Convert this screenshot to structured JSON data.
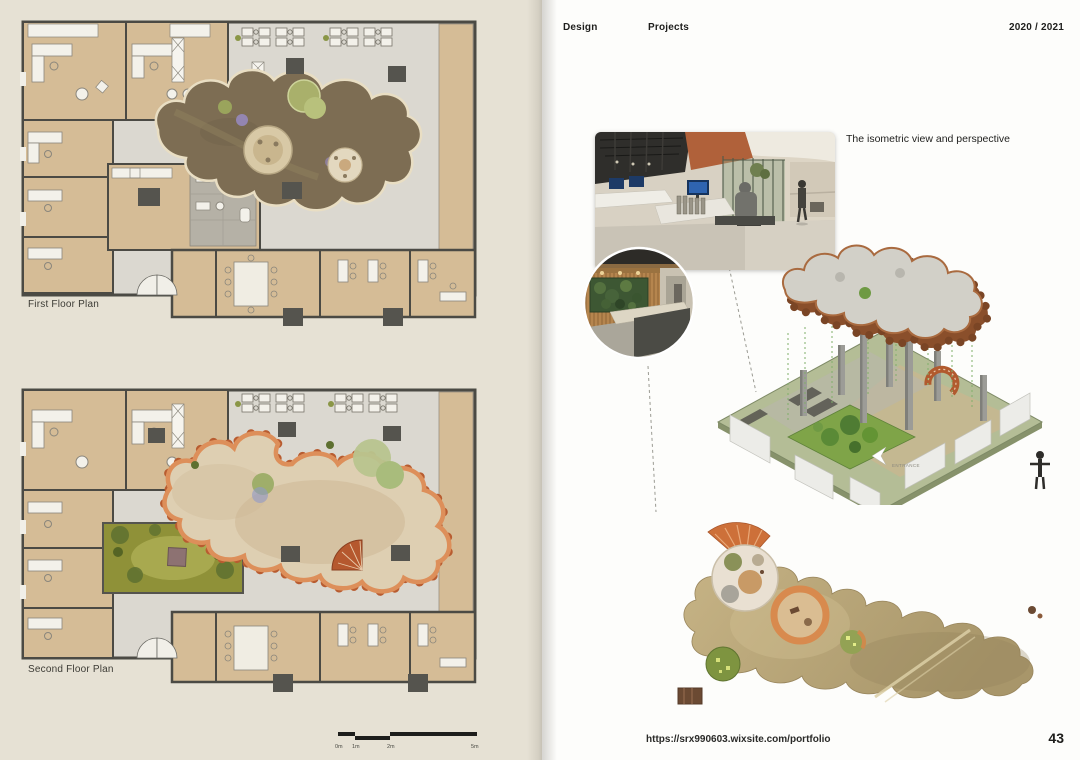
{
  "left_page": {
    "first_plan_label": "First Floor Plan",
    "second_plan_label": "Second Floor Plan",
    "scale_bar": {
      "labels": [
        "0m",
        "1m",
        "2m",
        "5m"
      ]
    }
  },
  "right_page": {
    "header": {
      "design": "Design",
      "projects": "Projects",
      "year": "2020 / 2021"
    },
    "annotation": "The isometric view and perspective",
    "isometric": {
      "entrance_label": "ENTRANCE"
    },
    "footer": {
      "url": "https://srx990603.wixsite.com/portfolio",
      "page_number": "43"
    }
  },
  "colors": {
    "left_page_bg": "#e6e1d4",
    "right_page_bg": "#fdfdfb",
    "plan_floor": "#dbd8d0",
    "plan_room_tan": "#d5bc96",
    "plan_wall": "#4b4a44",
    "column_gray": "#55544e",
    "blob_first_floor": "#7d6d53",
    "blob_rim_cream": "#e9dec3",
    "blob_second_floor_fill": "#decfb2",
    "blob_second_floor_rim": "#c06a3a",
    "courtyard_green": "#8f9138",
    "pod_green": "#a9b06b",
    "iso_base_green": "#b4bd96",
    "roof_terracotta": "#8a4f2b",
    "bottom_blob_khaki": "#b7a477"
  }
}
